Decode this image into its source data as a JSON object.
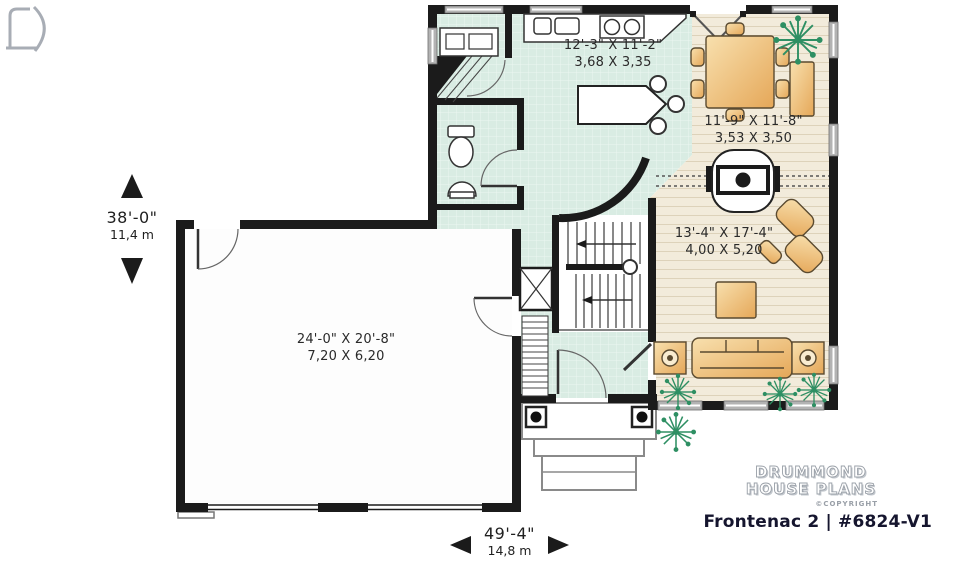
{
  "plan": {
    "title": "Frontenac 2 | #6824-V1",
    "brand_line1": "DRUMMOND",
    "brand_line2": "HOUSE PLANS",
    "copyright": "©COPYRIGHT"
  },
  "overall_dimensions": {
    "depth_imperial": "38'-0\"",
    "depth_metric": "11,4 m",
    "width_imperial": "49'-4\"",
    "width_metric": "14,8 m"
  },
  "rooms": {
    "kitchen": {
      "imperial": "12'-3\" X 11'-2\"",
      "metric": "3,68 X 3,35"
    },
    "dining": {
      "imperial": "11'-9\" X 11'-8\"",
      "metric": "3,53 X 3,50"
    },
    "living": {
      "imperial": "13'-4\" X 17'-4\"",
      "metric": "4,00 X 5,20"
    },
    "garage": {
      "imperial": "24'-0\" X 20'-8\"",
      "metric": "7,20 X 6,20"
    }
  },
  "colors": {
    "wall": "#1b1b1b",
    "tile_floor": "#d9ece3",
    "wood_floor": "#f2ebdb",
    "furniture_tan": "#eeb96e",
    "plant_green": "#2e8f63",
    "title_text": "#15152e"
  }
}
